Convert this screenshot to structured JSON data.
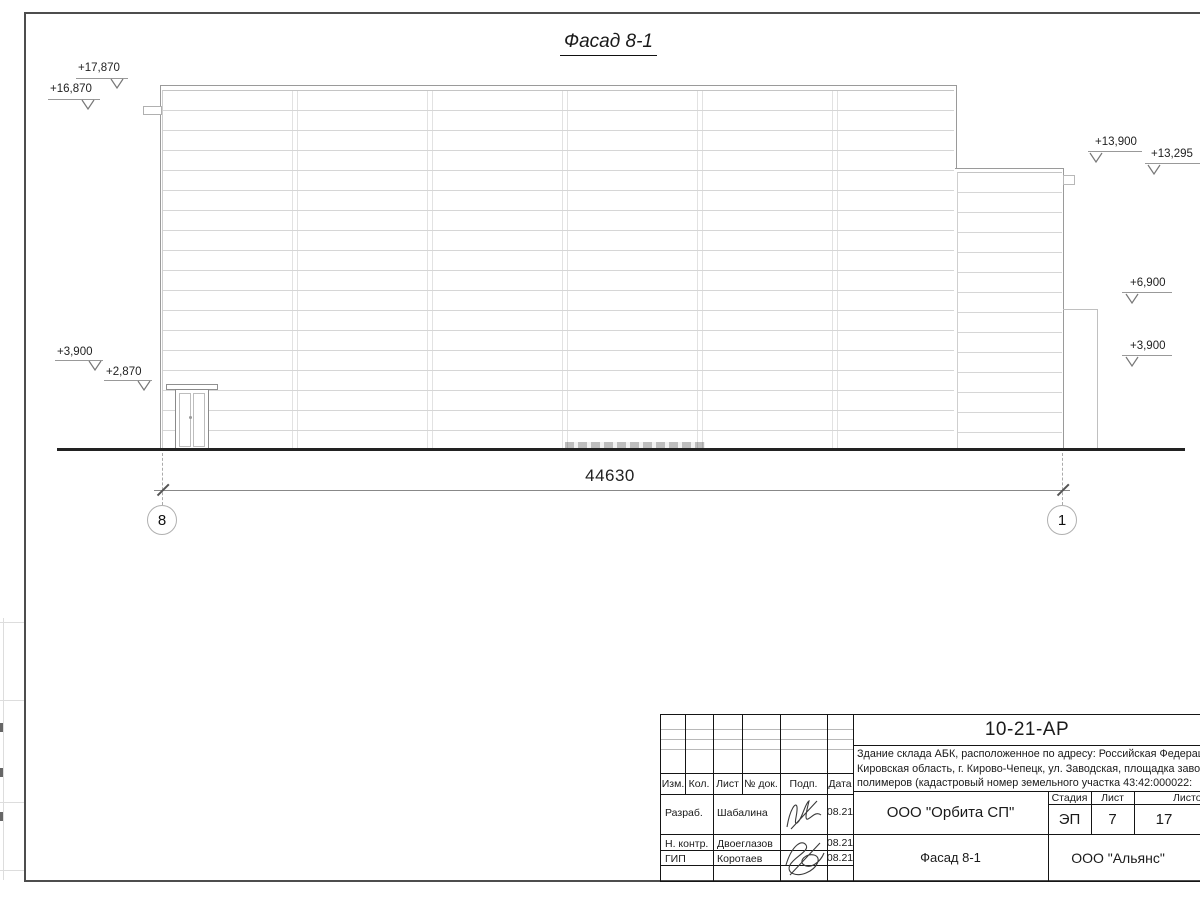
{
  "sheet": {
    "view_title": "Фасад 8-1",
    "dimension_total": "44630",
    "axes": {
      "left": "8",
      "right": "1"
    },
    "elevations": {
      "e17870": "+17,870",
      "e16870": "+16,870",
      "e13900": "+13,900",
      "e13295": "+13,295",
      "e6900": "+6,900",
      "e3900_right": "+3,900",
      "e3900_left": "+3,900",
      "e2870": "+2,870"
    }
  },
  "title_block": {
    "doc_number": "10-21-АР",
    "project_description": [
      "Здание склада АБК, расположенное по адресу: Российская Федерация,",
      "Кировская область, г. Кирово-Чепецк, ул. Заводская, площадка завода",
      "полимеров (кадастровый номер земельного участка 43:42:000022:"
    ],
    "header_columns": [
      "Изм.",
      "Кол.",
      "Лист",
      "№ док.",
      "Подп.",
      "Дата"
    ],
    "roles": {
      "developer_label": "Разраб.",
      "developer_name": "Шабалина",
      "developer_date": "08.21",
      "checker_label": "Н. контр.",
      "checker_name": "Двоеглазов",
      "checker_date": "08.21",
      "gip_label": "ГИП",
      "gip_name": "Коротаев",
      "gip_date": "08.21"
    },
    "organization": "ООО \"Орбита СП\"",
    "stage_label": "Стадия",
    "stage_value": "ЭП",
    "sheet_label": "Лист",
    "sheet_value": "7",
    "sheets_label": "Листов",
    "sheets_value": "17",
    "sheet_title": "Фасад 8-1",
    "contractor": "ООО \"Альянс\""
  }
}
